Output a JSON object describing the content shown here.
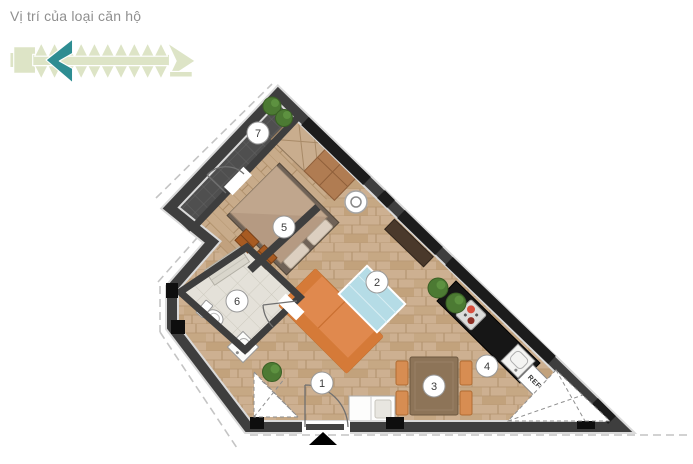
{
  "header": {
    "title": "Vị trí của loại căn hộ"
  },
  "key_plan": {
    "unit_color": "#dde4c6",
    "highlight_color": "#2e8d92",
    "outline_color": "#ffffff"
  },
  "floor_plan": {
    "room_markers": [
      {
        "number": "1"
      },
      {
        "number": "2"
      },
      {
        "number": "3"
      },
      {
        "number": "4"
      },
      {
        "number": "5"
      },
      {
        "number": "6"
      },
      {
        "number": "7"
      }
    ],
    "labels": {
      "refrigerator": "REF"
    },
    "colors": {
      "wall": "#3e3e3e",
      "window": "#1c1c1c",
      "wood_floor": "#cdb091",
      "bedroom_floor": "#c8ab8a",
      "bath_floor": "#e4e1d9",
      "balcony_tile": "#4f4f4f",
      "sofa": "#e0894e",
      "rug": "#b5dce6",
      "counter": "#161616",
      "table": "#8d7458",
      "chair": "#d78d52",
      "plant": "#4c7a33",
      "bed": "#b59a82",
      "drawer": "#a85b22",
      "dash": "#c4c4c4",
      "marker_border": "#9a9a9a"
    }
  }
}
